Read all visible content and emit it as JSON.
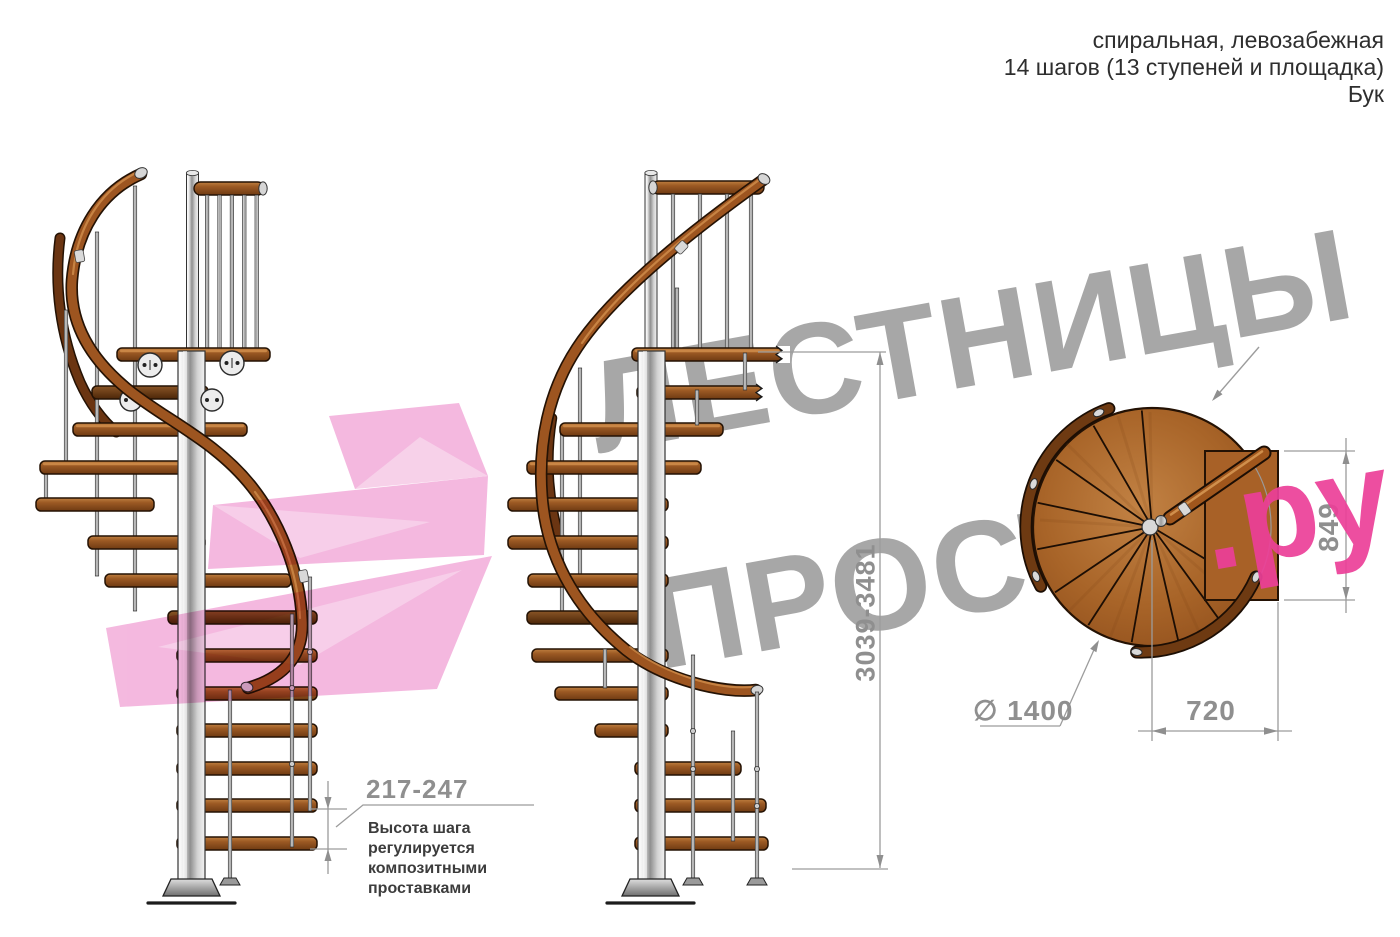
{
  "header": {
    "line1": "спиральная, левозабежная",
    "line2": "14 шагов (13 ступеней и площадка)",
    "line3": "Бук"
  },
  "watermark": {
    "line1": "ЛЕСТНИЦЫ",
    "line2_gray": "ПРОСТО",
    "line2_pink": ".ру"
  },
  "dimensions": {
    "step_height": "217-247",
    "step_height_note": "Высота шага\nрегулируется\nкомпозитными\nпроставками",
    "total_height": "3039-3481",
    "plan_diameter": "∅ 1400",
    "plan_landing_width": "720",
    "plan_landing_depth": "849"
  },
  "colors": {
    "accent_pink": "#ec3f98",
    "arrow_pink": "#f2a9d8",
    "watermark_gray": "#a7a7a7",
    "dimension_gray": "#8f8f8f",
    "wood_brown": "#9c5a24",
    "pole_chrome": "#c9c9c9"
  }
}
